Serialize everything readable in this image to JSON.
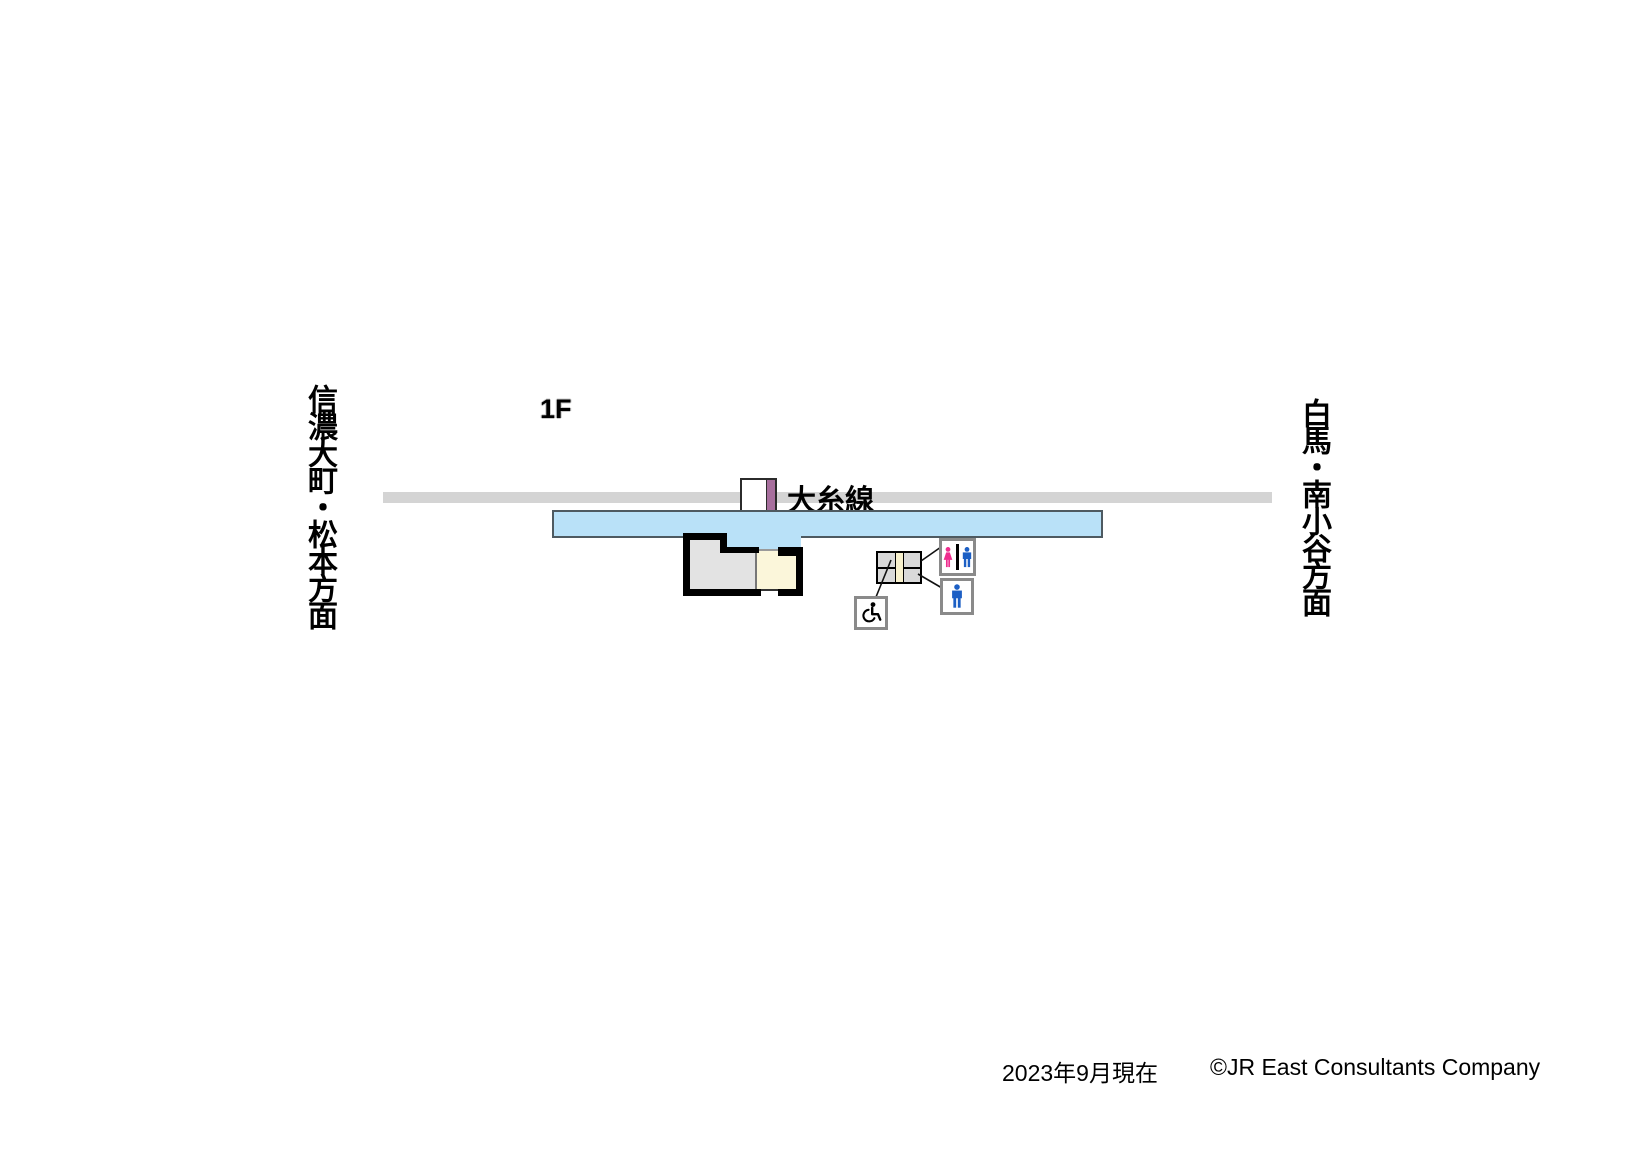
{
  "floor_label": "1F",
  "track": {
    "line_label": "大糸線"
  },
  "directions": {
    "left": "信濃大町・松本方面",
    "right": "白馬・南小谷方面"
  },
  "footer": {
    "date_note": "2023年9月現在",
    "copyright": "©JR East Consultants Company"
  },
  "colors": {
    "platform_blue": "#B9E1F8",
    "track_gray": "#D4D4D4",
    "building_wall_black": "#000000",
    "room_gray": "#E3E3E3",
    "room_cream": "#FBF6DA",
    "stairs_strip_cream": "#F8F1CD",
    "signal_stripe_purple": "#A76F9D",
    "female_pink": "#EE2D8E",
    "male_blue": "#1C5FC4",
    "sign_border_gray": "#8A8A8A"
  },
  "icons": {
    "stairs": "stairs-icon",
    "restroom": "restroom-sign (female + male)",
    "mens_room": "mens-room-sign",
    "wheelchair": "wheelchair-accessible-sign"
  }
}
